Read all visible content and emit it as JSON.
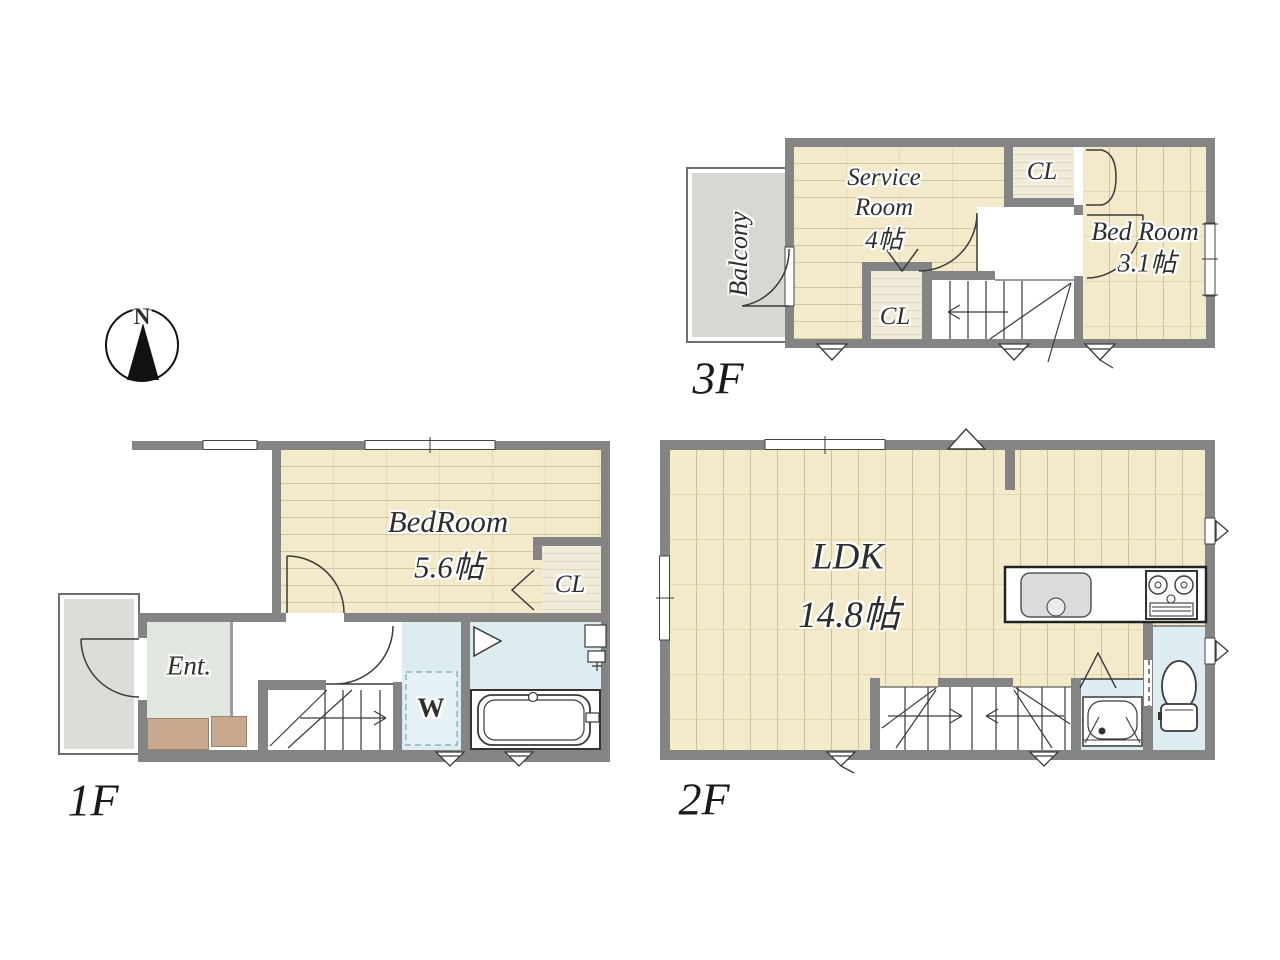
{
  "compass": {
    "north": "N"
  },
  "floor3": {
    "label": "3F",
    "balcony": "Balcony",
    "service_room": {
      "line1": "Service",
      "line2": "Room",
      "size": "4帖"
    },
    "closet_top": "CL",
    "closet_lower": "CL",
    "bedroom": {
      "name": "Bed Room",
      "size": "3.1帖"
    }
  },
  "floor1": {
    "label": "1F",
    "bedroom": {
      "name": "BedRoom",
      "size": "5.6帖"
    },
    "closet": "CL",
    "entrance": "Ent.",
    "washer": "W"
  },
  "floor2": {
    "label": "2F",
    "ldk": {
      "name": "LDK",
      "size": "14.8帖"
    }
  },
  "colors": {
    "wall": "#848484",
    "wood_floor": "#f3e9cb",
    "closet_floor": "#f1ecd9",
    "wet_area": "#ddecf1",
    "balcony_tile": "#d6d8d1",
    "porch_tile": "#dbded6",
    "entrance_tile": "#e1e6df",
    "shoe_cabinet": "#c8a88f",
    "label_text": "#2e2e2e"
  }
}
